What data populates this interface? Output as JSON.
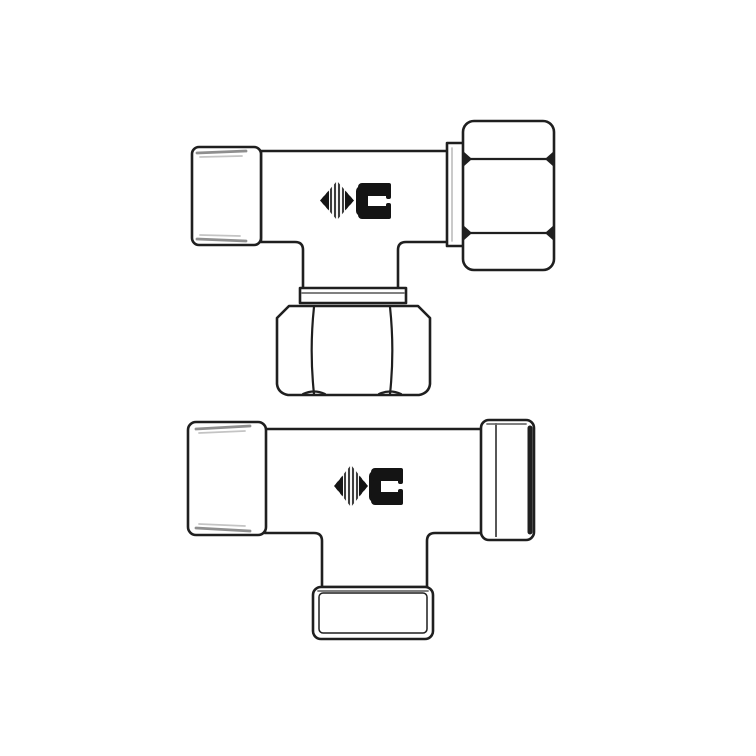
{
  "logo": {
    "letter": "C"
  },
  "colors": {
    "paper": "#ffffff",
    "line": "#1f1f1f",
    "hatch": "#8f8f8f",
    "hatch-light": "#c4c4c4",
    "logo": "#141414",
    "logo-stripe": "#3d3d3d",
    "band": "#6e6e6e"
  }
}
